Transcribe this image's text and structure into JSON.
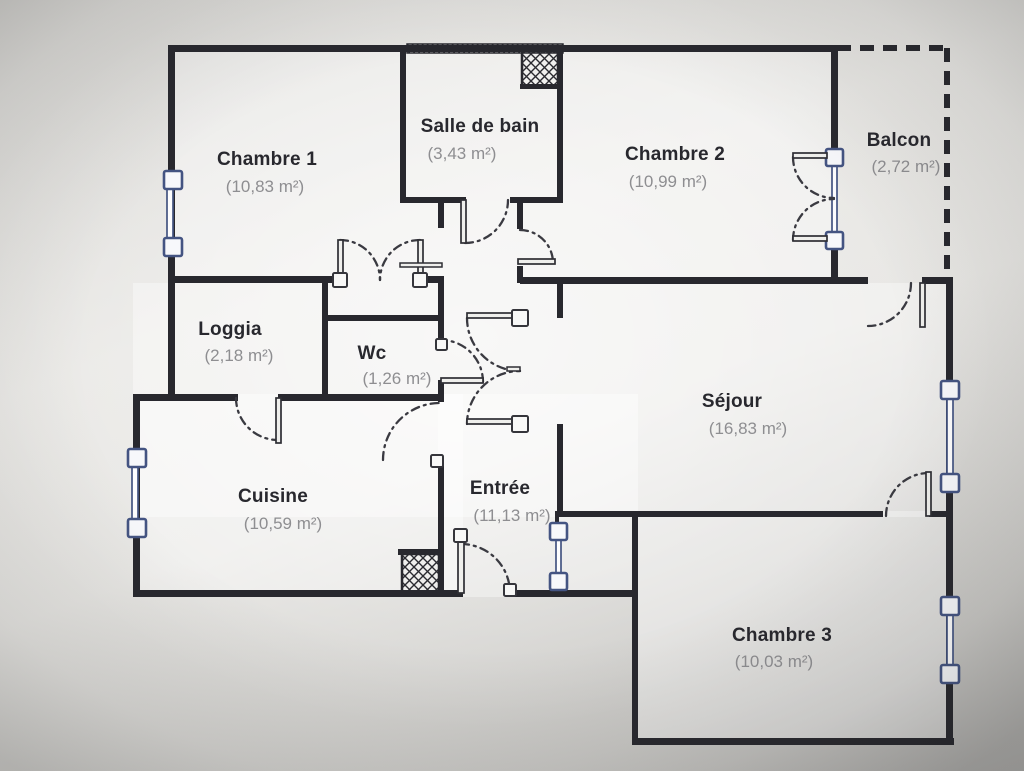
{
  "meta": {
    "width": 1024,
    "height": 771,
    "kind": "apartment-floor-plan"
  },
  "palette": {
    "wall": "#28282e",
    "arc": "#3a3a41",
    "leaf_fill": "#efefec",
    "leaf_stroke": "#2e2e34",
    "window_frame": "#445482",
    "window_fill": "#f7f8fb",
    "glass_fill": "#fdfdfe",
    "label": "#28282e",
    "area_label": "#8e8e91",
    "floor_fill": "rgba(255,255,255,0.38)"
  },
  "rooms": [
    {
      "name": "Chambre 1",
      "area": "(10,83 m²)",
      "nx": 267,
      "ny": 165,
      "ax": 265,
      "ay": 192
    },
    {
      "name": "Salle de bain",
      "area": "(3,43 m²)",
      "nx": 480,
      "ny": 132,
      "ax": 462,
      "ay": 159
    },
    {
      "name": "Chambre 2",
      "area": "(10,99 m²)",
      "nx": 675,
      "ny": 160,
      "ax": 668,
      "ay": 187
    },
    {
      "name": "Balcon",
      "area": "(2,72 m²)",
      "nx": 899,
      "ny": 146,
      "ax": 906,
      "ay": 172
    },
    {
      "name": "Loggia",
      "area": "(2,18 m²)",
      "nx": 230,
      "ny": 335,
      "ax": 239,
      "ay": 361
    },
    {
      "name": "Wc",
      "area": "(1,26 m²)",
      "nx": 372,
      "ny": 359,
      "ax": 397,
      "ay": 384
    },
    {
      "name": "Séjour",
      "area": "(16,83 m²)",
      "nx": 732,
      "ny": 407,
      "ax": 748,
      "ay": 434
    },
    {
      "name": "Cuisine",
      "area": "(10,59 m²)",
      "nx": 273,
      "ny": 502,
      "ax": 283,
      "ay": 529
    },
    {
      "name": "Entrée",
      "area": "(11,13 m²)",
      "nx": 500,
      "ny": 494,
      "ax": 512,
      "ay": 521
    },
    {
      "name": "Chambre 3",
      "area": "(10,03 m²)",
      "nx": 782,
      "ny": 641,
      "ax": 774,
      "ay": 667
    }
  ],
  "plan": {
    "floor_rects": [
      [
        168,
        45,
        669,
        238
      ],
      [
        133,
        283,
        820,
        234
      ],
      [
        133,
        394,
        330,
        203
      ],
      [
        438,
        394,
        200,
        203
      ],
      [
        632,
        511,
        321,
        234
      ]
    ],
    "walls": [
      [
        168,
        45,
        669,
        7
      ],
      [
        168,
        45,
        7,
        238
      ],
      [
        168,
        276,
        172,
        7
      ],
      [
        420,
        276,
        23,
        7
      ],
      [
        168,
        283,
        7,
        117
      ],
      [
        133,
        394,
        42,
        7
      ],
      [
        133,
        394,
        7,
        203
      ],
      [
        133,
        590,
        330,
        7
      ],
      [
        512,
        590,
        126,
        7
      ],
      [
        632,
        511,
        6,
        234
      ],
      [
        632,
        738,
        322,
        7
      ],
      [
        946,
        277,
        7,
        468
      ],
      [
        520,
        277,
        348,
        7
      ],
      [
        922,
        277,
        28,
        7
      ],
      [
        831,
        45,
        7,
        105
      ],
      [
        831,
        247,
        7,
        36
      ],
      [
        400,
        48,
        6,
        151
      ],
      [
        400,
        197,
        66,
        6
      ],
      [
        510,
        197,
        53,
        6
      ],
      [
        557,
        48,
        6,
        155
      ],
      [
        438,
        197,
        6,
        31
      ],
      [
        438,
        276,
        6,
        44
      ],
      [
        322,
        283,
        6,
        114
      ],
      [
        322,
        315,
        122,
        6
      ],
      [
        438,
        315,
        6,
        30
      ],
      [
        438,
        380,
        6,
        22
      ],
      [
        168,
        394,
        70,
        7
      ],
      [
        278,
        394,
        166,
        7
      ],
      [
        438,
        458,
        6,
        137
      ],
      [
        517,
        203,
        6,
        26
      ],
      [
        517,
        266,
        6,
        17
      ],
      [
        557,
        283,
        6,
        35
      ],
      [
        557,
        424,
        6,
        91
      ],
      [
        557,
        511,
        326,
        6
      ],
      [
        929,
        511,
        19,
        6
      ],
      [
        555,
        511,
        4,
        14
      ],
      [
        555,
        583,
        4,
        9
      ],
      [
        398,
        549,
        46,
        6
      ],
      [
        520,
        84,
        40,
        5
      ]
    ],
    "balcony_dashes": [
      [
        837,
        48,
        947,
        48
      ],
      [
        947,
        48,
        947,
        281
      ]
    ],
    "hatch_strip": [
      407,
      44,
      156,
      9
    ],
    "ducts": [
      [
        522,
        51,
        36,
        35
      ],
      [
        402,
        554,
        37,
        38
      ]
    ],
    "door_arcs": [
      "M 465 243 A 43 43 0 0 0 508 200",
      "M 340 240 A 40 40 0 0 1 380 280",
      "M 420 240 A 40 40 0 0 0 380 280",
      "M 520 230 A 33 33 0 0 1 553 263",
      "M 793 157 A 41 41 0 0 0 834 198",
      "M 793 240 A 41 41 0 0 1 834 199",
      "M 467 318 A 53 53 0 0 0 520 371",
      "M 467 424 A 53 53 0 0 1 520 371",
      "M 483 382 A 42 42 0 0 0 441 340",
      "M 383 460 A 57 57 0 0 1 440 403",
      "M 236 398 A 42 42 0 0 0 278 440",
      "M 911 283 A 43 43 0 0 1 868 326",
      "M 886 516 A 43 43 0 0 1 929 473",
      "M 461 544 A 49 49 0 0 1 510 593"
    ],
    "door_leaves": [
      [
        461,
        200,
        5,
        43
      ],
      [
        338,
        240,
        5,
        40
      ],
      [
        418,
        240,
        5,
        40
      ],
      [
        518,
        259,
        37,
        5
      ],
      [
        793,
        153,
        34,
        5
      ],
      [
        793,
        236,
        34,
        5
      ],
      [
        467,
        313,
        53,
        5
      ],
      [
        467,
        419,
        53,
        5
      ],
      [
        441,
        378,
        42,
        5
      ],
      [
        276,
        398,
        5,
        45
      ],
      [
        920,
        283,
        5,
        44
      ],
      [
        926,
        472,
        5,
        44
      ],
      [
        458,
        537,
        6,
        56
      ]
    ],
    "door_ticks": [
      [
        400,
        263,
        42,
        4
      ],
      [
        507,
        367,
        13,
        4
      ]
    ],
    "door_nodes": [
      [
        333,
        273,
        14
      ],
      [
        413,
        273,
        14
      ],
      [
        512,
        310,
        16
      ],
      [
        512,
        416,
        16
      ],
      [
        436,
        339,
        11
      ],
      [
        431,
        455,
        12
      ],
      [
        454,
        529,
        13
      ],
      [
        504,
        584,
        12
      ]
    ],
    "windows": [
      {
        "glass": [
          167,
          172,
          6,
          80
        ],
        "squares": [
          [
            164,
            171
          ],
          [
            164,
            238
          ]
        ],
        "size": 18
      },
      {
        "glass": [
          132,
          451,
          6,
          84
        ],
        "squares": [
          [
            128,
            449
          ],
          [
            128,
            519
          ]
        ],
        "size": 18
      },
      {
        "glass": [
          947,
          384,
          6,
          104
        ],
        "squares": [
          [
            941,
            381
          ],
          [
            941,
            474
          ]
        ],
        "size": 18
      },
      {
        "glass": [
          947,
          599,
          6,
          84
        ],
        "squares": [
          [
            941,
            597
          ],
          [
            941,
            665
          ]
        ],
        "size": 18
      },
      {
        "glass": [
          556,
          525,
          5,
          60
        ],
        "squares": [
          [
            550,
            523
          ],
          [
            550,
            573
          ]
        ],
        "size": 17
      },
      {
        "glass": [
          832,
          152,
          5,
          93
        ],
        "squares": [
          [
            826,
            149
          ],
          [
            826,
            232
          ]
        ],
        "size": 17
      }
    ]
  }
}
